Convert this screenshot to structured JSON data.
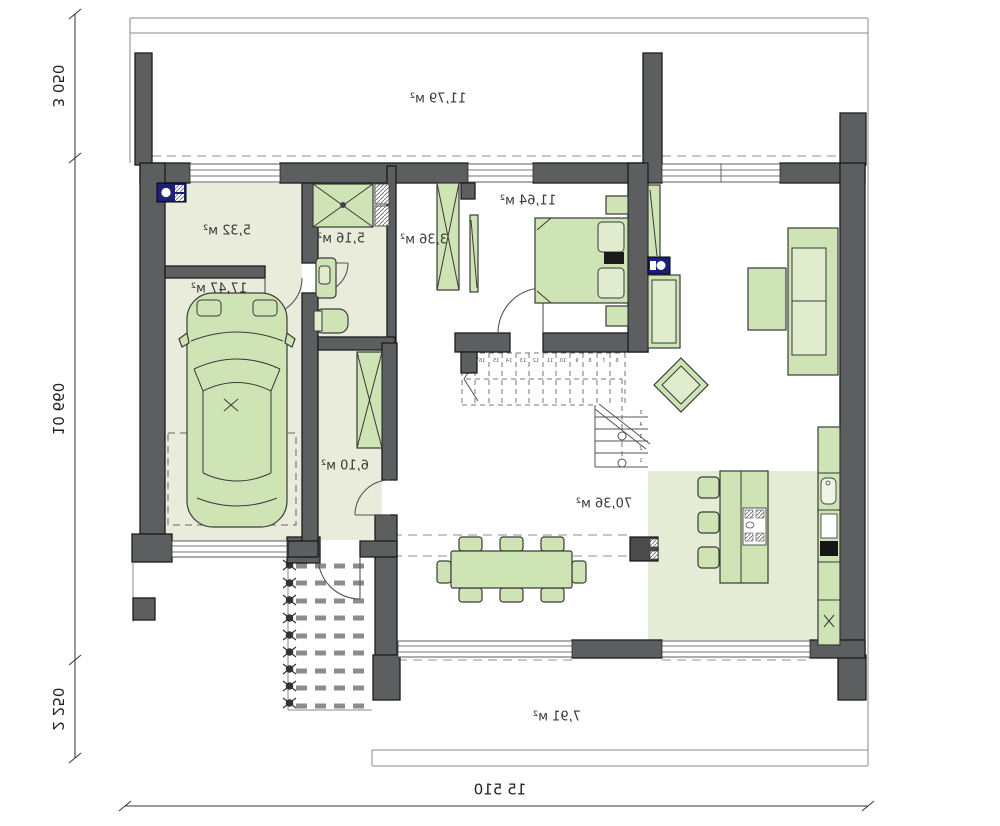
{
  "plan": {
    "type": "architectural-floor-plan",
    "mirrored": true,
    "rooms": {
      "balcony": {
        "area": "11,79 м²"
      },
      "utility": {
        "area": "5,32 м²"
      },
      "garage": {
        "area": "17,47 м²"
      },
      "bathroom": {
        "area": "5,16 м²"
      },
      "closet": {
        "area": "3,36 м²"
      },
      "bedroom": {
        "area": "11,64 м²"
      },
      "hall": {
        "area": "6,10 м²"
      },
      "living": {
        "area": "70,36 м²"
      },
      "terrace": {
        "area": "7,91 м²"
      }
    },
    "dimensions": {
      "left_top": "3 050",
      "left_middle": "10 660",
      "left_bottom": "2 250",
      "bottom": "15 510"
    },
    "stairs": {
      "upper": [
        "17",
        "16",
        "15",
        "14",
        "13",
        "12",
        "11",
        "10",
        "9",
        "8",
        "7",
        "6"
      ],
      "lower": [
        "5",
        "4",
        "3",
        "2",
        "1"
      ]
    },
    "colors": {
      "wall": "#5c5e60",
      "floor": "#e9ecdb",
      "kitchen_floor": "#e5ecd6",
      "furniture": "#cfe4b5",
      "accent_blue": "#1b1f7e"
    }
  }
}
